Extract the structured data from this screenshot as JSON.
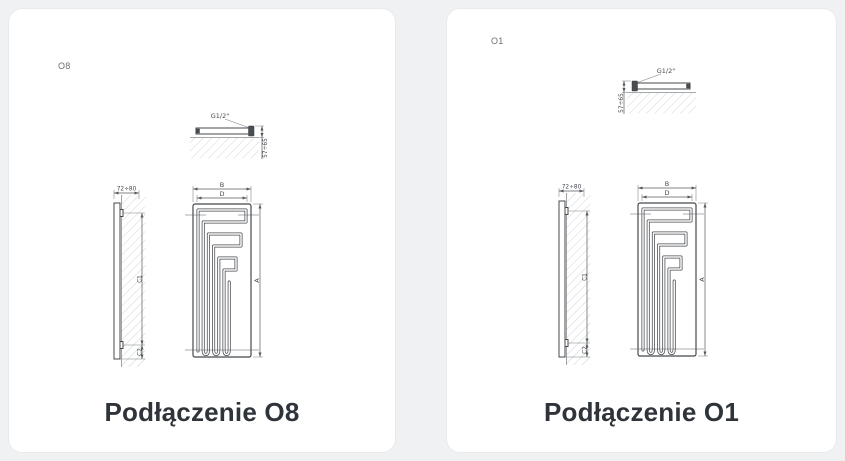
{
  "page": {
    "background": "#f0f1f3",
    "card_background": "#ffffff",
    "line_color": "#45494e",
    "hatch_color": "#c3c7cb",
    "caption_color": "#2f343a"
  },
  "panels": [
    {
      "code": "O8",
      "caption": "Podłączenie O8",
      "dims": {
        "thread": "G1/2\"",
        "wall_distance": "57÷65",
        "depth": "72÷80",
        "outer_width": "B",
        "inner_width": "D",
        "height": "A",
        "bracket_span": "C1",
        "bracket_offset": "C2"
      }
    },
    {
      "code": "O1",
      "caption": "Podłączenie O1",
      "dims": {
        "thread": "G1/2\"",
        "wall_distance": "57÷65",
        "depth": "72÷80",
        "outer_width": "B",
        "inner_width": "D",
        "height": "A",
        "bracket_span": "C1",
        "bracket_offset": "C2"
      }
    }
  ]
}
